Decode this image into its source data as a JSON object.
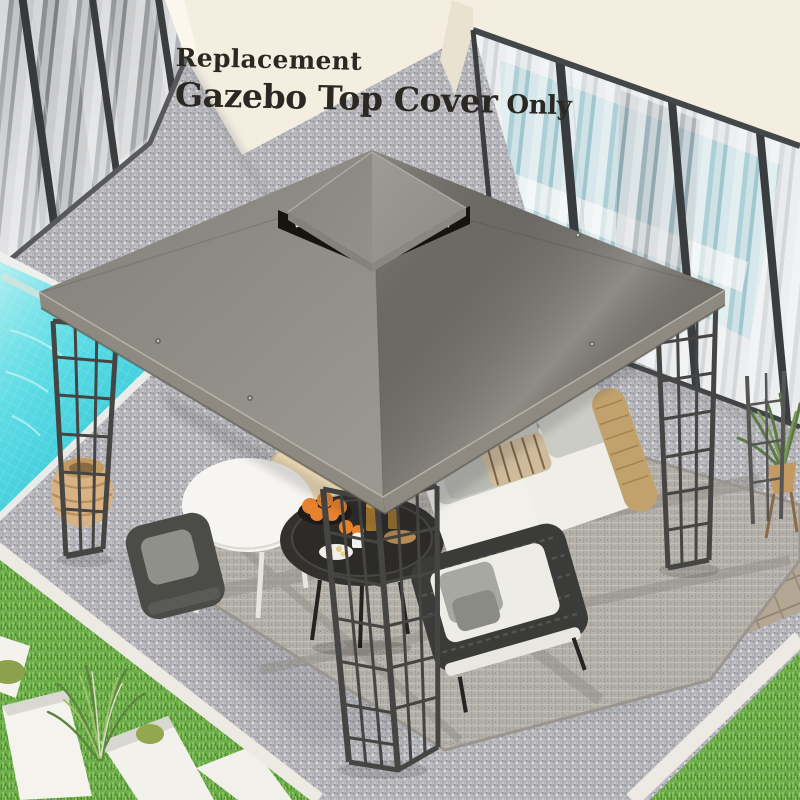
{
  "product_banner": {
    "line1": "Replacement",
    "line2_main": "Gazebo Top Cover",
    "line2_suffix": "Only"
  },
  "palette": {
    "gravel": "#b8b8bc",
    "wall_cream": "#f4eee0",
    "pool_water": "#3bd0dd",
    "grass": "#6fae4c",
    "rug_gray": "#b4b0aa",
    "canopy_gray": "#8f8c86",
    "canopy_top": "#8c8984",
    "canopy_edge": "#8e8a81",
    "vent_black": "#16140f",
    "frame_metal": "#454543",
    "rattan_tan": "#c2a26c",
    "orange_fruit": "#e8832d",
    "paver_tan": "#b4a794",
    "text_charcoal": "#2b2722"
  }
}
